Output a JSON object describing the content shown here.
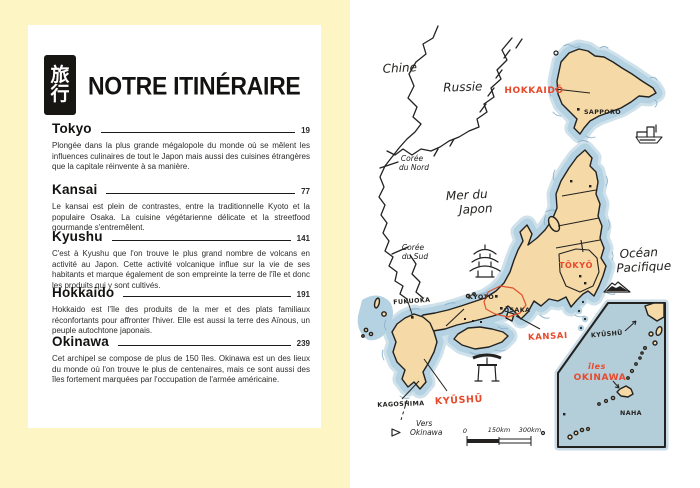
{
  "left": {
    "stamp": {
      "top": "旅",
      "bottom": "行"
    },
    "title": "NOTRE ITINÉRAIRE",
    "sections": [
      {
        "title": "Tokyo",
        "page": "19",
        "body": "Plongée dans la plus grande mégalopole du monde où se mêlent les influences culinaires de tout le Japon mais aussi des cuisines étrangères que la capitale réinvente à sa manière."
      },
      {
        "title": "Kansai",
        "page": "77",
        "body": "Le kansai est plein de contrastes, entre la traditionnelle Kyoto et la populaire Osaka. La cuisine végétarienne délicate et la streetfood gourmande s'entremêlent."
      },
      {
        "title": "Kyushu",
        "page": "141",
        "body": "C'est à Kyushu que l'on trouve le plus grand nombre de volcans en activité au Japon. Cette activité volcanique influe sur la vie de ses habitants et marque également de son empreinte la terre de l'île et donc les produits qui y sont cultivés."
      },
      {
        "title": "Hokkaido",
        "page": "191",
        "body": "Hokkaido est l'île des produits de la mer et des plats familiaux réconfortants pour affronter l'hiver. Elle est aussi la terre des Aïnous, un peuple autochtone japonais."
      },
      {
        "title": "Okinawa",
        "page": "239",
        "body": "Cet archipel se compose de plus de 150 îles. Okinawa est un des lieux du monde où l'on trouve le plus de centenaires, mais ce sont aussi des îles fortement marquées par l'occupation de l'armée américaine."
      }
    ]
  },
  "map": {
    "labels": {
      "chine": "Chine",
      "russie": "Russie",
      "hokkaido": "HOKKAIDŌ",
      "sapporo": "SAPPORO",
      "coree_nord_1": "Corée",
      "coree_nord_2": "du Nord",
      "mer_japon_1": "Mer du",
      "mer_japon_2": "Japon",
      "coree_sud_1": "Corée",
      "coree_sud_2": "du Sud",
      "fukuoka": "FUKUOKA",
      "kyoto": "KYOTO",
      "osaka": "ŌSAKA",
      "tokyo": "TŌKYŌ",
      "ocean_1": "Océan",
      "ocean_2": "Pacifique",
      "kansai": "KANSAI",
      "kyushu": "KYŪSHŪ",
      "kagoshima": "KAGOSHIMA",
      "vers_1": "Vers",
      "vers_2": "Okinawa",
      "inset_kyushu": "KYŪSHŪ",
      "iles_1": "îles",
      "iles_2": "OKINAWA",
      "naha": "NAHA"
    },
    "scale": {
      "zero": "0",
      "mid": "150km",
      "end": "300km"
    },
    "colors": {
      "ink": "#232220",
      "land": "#f5d9a7",
      "water": "#b5d2e2",
      "water-edge": "#8fb3c9",
      "inset-water": "#b3cdd9",
      "red": "#e8492b",
      "kansai": "#e0512c",
      "yellow": "#fdf5c3",
      "paper": "#ffffff"
    }
  }
}
